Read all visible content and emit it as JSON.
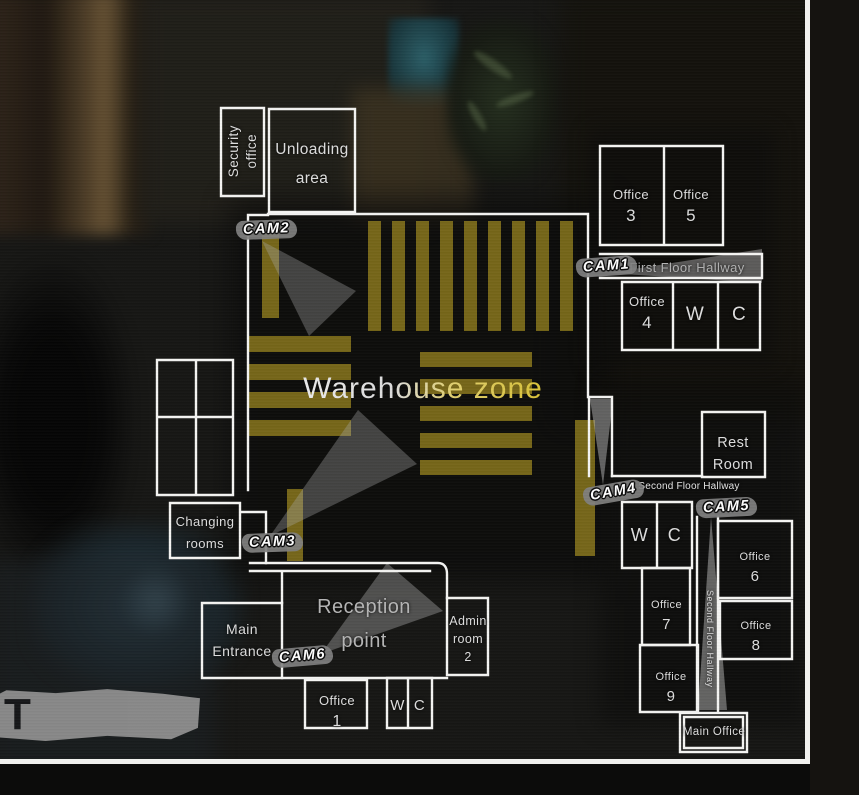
{
  "zones": {
    "warehouse": "Warehouse zone",
    "first_floor_hallway": "First Floor Hallway",
    "second_floor_hallway": "Second Floor Hallway",
    "second_floor_hallway_vertical": "Second Floor Hallway"
  },
  "rooms": {
    "security_office": {
      "lines": [
        "Security",
        "office"
      ]
    },
    "unloading_area": {
      "lines": [
        "Unloading",
        "area"
      ]
    },
    "office3": {
      "name": "Office",
      "number": "3"
    },
    "office5": {
      "name": "Office",
      "number": "5"
    },
    "office4": {
      "name": "Office",
      "number": "4"
    },
    "wc_first_floor": {
      "w": "W",
      "c": "C"
    },
    "changing_rooms": {
      "lines": [
        "Changing",
        "rooms"
      ]
    },
    "rest_room": {
      "lines": [
        "Rest",
        "Room"
      ]
    },
    "wc_second_floor": {
      "w": "W",
      "c": "C"
    },
    "office6": {
      "name": "Office",
      "number": "6"
    },
    "office7": {
      "name": "Office",
      "number": "7"
    },
    "office8": {
      "name": "Office",
      "number": "8"
    },
    "office9": {
      "name": "Office",
      "number": "9"
    },
    "main_office": "Main Office",
    "main_entrance": {
      "lines": [
        "Main",
        "Entrance"
      ]
    },
    "reception_point": {
      "lines": [
        "Reception",
        "point"
      ]
    },
    "admin_room": {
      "lines": [
        "Admin",
        "room",
        "2"
      ]
    },
    "office1": {
      "name": "Office",
      "number": "1"
    },
    "wc_ground_floor": {
      "w": "W",
      "c": "C"
    }
  },
  "cameras": {
    "cam1": "CAM1",
    "cam2": "CAM2",
    "cam3": "CAM3",
    "cam4": "CAM4",
    "cam5": "CAM5",
    "cam6": "CAM6"
  },
  "colors": {
    "wall": "#f5f5f3",
    "stripe": "#8d7a1d",
    "cone": "#a9a9a9",
    "frame": "#f1f1ee"
  },
  "background": {
    "banner_letter": "T"
  }
}
